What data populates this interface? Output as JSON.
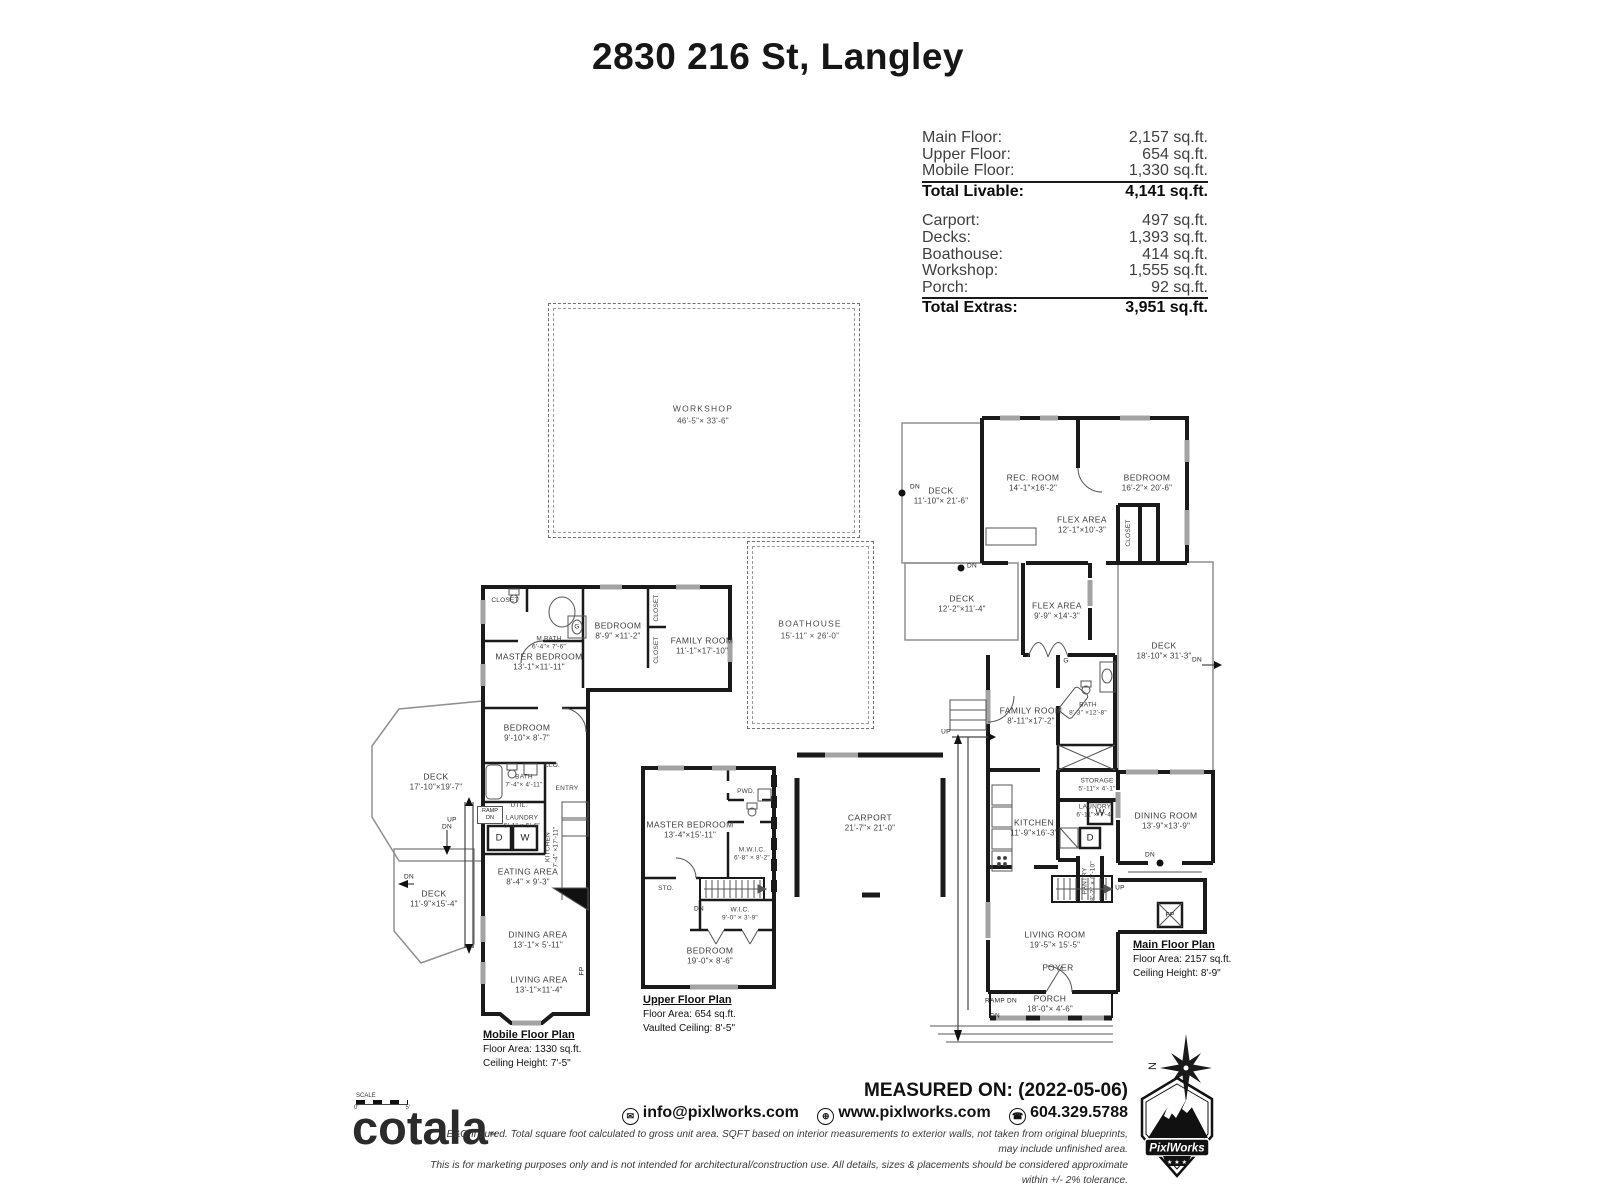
{
  "title": "2830 216 St, Langley",
  "area_summary": {
    "livable_rows": [
      {
        "label": "Main Floor:",
        "value": "2,157 sq.ft."
      },
      {
        "label": "Upper Floor:",
        "value": "654 sq.ft."
      },
      {
        "label": "Mobile Floor:",
        "value": "1,330 sq.ft."
      }
    ],
    "total_livable": {
      "label": "Total Livable:",
      "value": "4,141 sq.ft."
    },
    "extras_rows": [
      {
        "label": "Carport:",
        "value": "497 sq.ft."
      },
      {
        "label": "Decks:",
        "value": "1,393 sq.ft."
      },
      {
        "label": "Boathouse:",
        "value": "414 sq.ft."
      },
      {
        "label": "Workshop:",
        "value": "1,555 sq.ft."
      },
      {
        "label": "Porch:",
        "value": "92 sq.ft."
      }
    ],
    "total_extras": {
      "label": "Total Extras:",
      "value": "3,951 sq.ft."
    }
  },
  "outbuildings": {
    "workshop": {
      "name": "WORKSHOP",
      "dims": "46'-5\"× 33'-6\""
    },
    "boathouse": {
      "name": "BOATHOUSE",
      "dims": "15'-11\" × 26'-0\""
    }
  },
  "markers": {
    "up": "UP",
    "dn": "DN",
    "ramp_dn": "RAMP DN",
    "washer": "W",
    "dryer": "D",
    "gas": "G",
    "fireplace": "FP"
  },
  "mobile_floor": {
    "plan_label": {
      "title": "Mobile Floor Plan",
      "area": "Floor Area: 1330 sq.ft.",
      "ceiling": "Ceiling Height: 7'-5\""
    },
    "rooms": [
      {
        "name": "MASTER BEDROOM",
        "dims": "13'-1\"×11'-11\""
      },
      {
        "name": "M.BATH",
        "dims": "6'-4\"× 7'-6\""
      },
      {
        "name": "CLOSET",
        "dims": ""
      },
      {
        "name": "BEDROOM",
        "dims": "8'-9\" ×11'-2\""
      },
      {
        "name": "CLOSET",
        "dims": ""
      },
      {
        "name": "CLOSET",
        "dims": ""
      },
      {
        "name": "FAMILY ROOM",
        "dims": "11'-1\"×17'-10\""
      },
      {
        "name": "BEDROOM",
        "dims": "9'-10\"× 8'-7\""
      },
      {
        "name": "DECK",
        "dims": "17'-10\"×19'-7\""
      },
      {
        "name": "BATH",
        "dims": "7'-4\"× 4'-11\""
      },
      {
        "name": "CLO.",
        "dims": ""
      },
      {
        "name": "ENTRY",
        "dims": ""
      },
      {
        "name": "UTIL.",
        "dims": ""
      },
      {
        "name": "LAUNDRY",
        "dims": "5'-1\" × 5'-6\""
      },
      {
        "name": "KITCHEN",
        "dims": "7'-4\" ×17'-11\""
      },
      {
        "name": "EATING AREA",
        "dims": "8'-4\" × 9'-3\""
      },
      {
        "name": "DECK",
        "dims": "11'-9\"×15'-4\""
      },
      {
        "name": "DINING AREA",
        "dims": "13'-1\"× 5'-11\""
      },
      {
        "name": "LIVING AREA",
        "dims": "13'-1\"×11'-4\""
      }
    ]
  },
  "upper_floor": {
    "plan_label": {
      "title": "Upper Floor Plan",
      "area": "Floor Area: 654 sq.ft.",
      "ceiling": "Vaulted Ceiling: 8'-5\""
    },
    "rooms": [
      {
        "name": "MASTER BEDROOM",
        "dims": "13'-4\"×15'-11\""
      },
      {
        "name": "PWD.",
        "dims": ""
      },
      {
        "name": "M.W.I.C.",
        "dims": "6'-8\" × 8'-2\""
      },
      {
        "name": "STO.",
        "dims": ""
      },
      {
        "name": "W.I.C.",
        "dims": "9'-0\" × 3'-9\""
      },
      {
        "name": "BEDROOM",
        "dims": "19'-0\"× 8'-6\""
      }
    ]
  },
  "main_floor": {
    "plan_label": {
      "title": "Main Floor Plan",
      "area": "Floor Area: 2157 sq.ft.",
      "ceiling": "Ceiling Height: 8'-9\""
    },
    "rooms": [
      {
        "name": "DECK",
        "dims": "11'-10\"× 21'-6\""
      },
      {
        "name": "REC. ROOM",
        "dims": "14'-1\"×16'-2\""
      },
      {
        "name": "BEDROOM",
        "dims": "16'-2\"× 20'-6\""
      },
      {
        "name": "FLEX AREA",
        "dims": "12'-1\"×10'-3\""
      },
      {
        "name": "CLOSET",
        "dims": ""
      },
      {
        "name": "DECK",
        "dims": "12'-2\"×11'-4\""
      },
      {
        "name": "FLEX AREA",
        "dims": "9'-9\" ×14'-3\""
      },
      {
        "name": "DECK",
        "dims": "18'-10\"× 31'-3\""
      },
      {
        "name": "FAMILY ROOM",
        "dims": "8'-11\"×17'-2\""
      },
      {
        "name": "BATH",
        "dims": "8'-3\" ×12'-8\""
      },
      {
        "name": "STORAGE",
        "dims": "5'-11\"× 4'-1\""
      },
      {
        "name": "LAUNDRY",
        "dims": "6'-11\"× 7'-4\""
      },
      {
        "name": "KITCHEN",
        "dims": "11'-9\"×16'-3\""
      },
      {
        "name": "PANTRY",
        "dims": "8'-2\" × 6'-10\""
      },
      {
        "name": "DINING ROOM",
        "dims": "13'-9\"×13'-9\""
      },
      {
        "name": "CARPORT",
        "dims": "21'-7\"× 21'-0\""
      },
      {
        "name": "LIVING ROOM",
        "dims": "19'-5\"× 15'-5\""
      },
      {
        "name": "FOYER",
        "dims": ""
      },
      {
        "name": "PORCH",
        "dims": "18'-0\"× 4'-6\""
      }
    ]
  },
  "footer": {
    "scale": {
      "label": "SCALE",
      "left_tick": "0'",
      "right_tick": "5'"
    },
    "brand": "cotala",
    "trademark": "™",
    "disclaimer_line1": "E&O Insured.  Total square foot calculated to gross unit area. SQFT based on interior measurements to exterior walls, not taken from original blueprints, may include unfinished area.",
    "disclaimer_line2": "This is for marketing purposes only and is not intended for architectural/construction use.  All details, sizes & placements should be considered approximate within +/- 2%  tolerance.",
    "measured_on": "MEASURED ON: (2022-05-06)",
    "contact": {
      "email": "info@pixlworks.com",
      "website": "www.pixlworks.com",
      "phone": "604.329.5788"
    },
    "logo_text": "PixlWorks",
    "compass_label": "N"
  }
}
